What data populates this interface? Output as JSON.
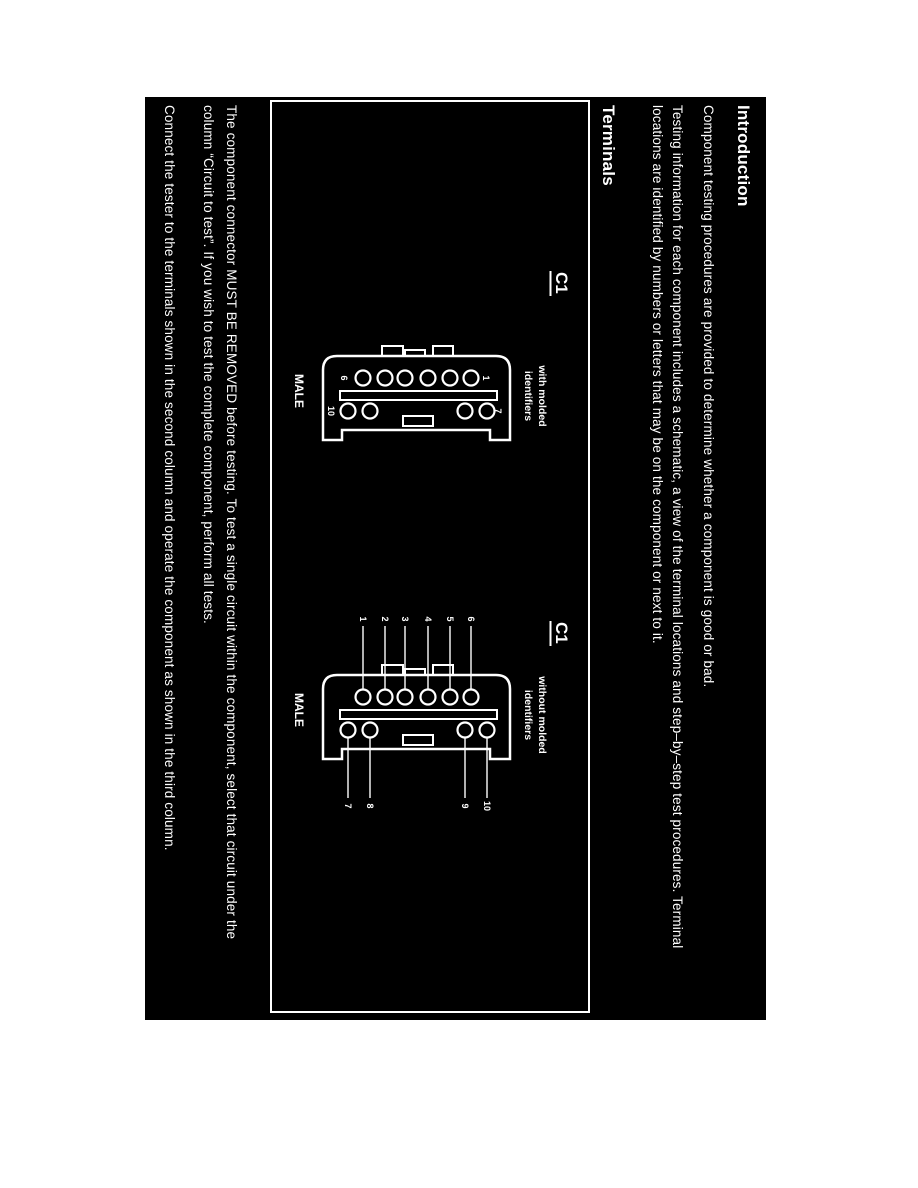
{
  "page": {
    "headings": {
      "introduction": "Introduction",
      "terminals": "Terminals"
    },
    "paragraphs": {
      "p1": "Component testing procedures are provided to determine whether a component is good or bad.",
      "p2_line1": "Testing information for each component includes a schematic, a view of the terminal locations and step–by–step test procedures. Terminal",
      "p2_line2": "locations are identified by numbers or letters that may be on the component or next to it.",
      "p3_line1": "The component connector MUST BE REMOVED before testing. To test a single circuit within the component, select that circuit under the",
      "p3_line2": "column “Circuit to test”. If you wish to test the complete component, perform all tests.",
      "p4": "Connect the tester to the terminals shown in the second column and operate the component as shown in the third column."
    }
  },
  "diagrams": [
    {
      "id": "C1",
      "variant_line1": "with molded",
      "variant_line2": "identifiers",
      "gender_label": "MALE",
      "row1_top_pin_label": "1",
      "row1_bottom_pin_label": "6",
      "row2_top_pin_label": "7",
      "row2_bottom_pin_label": "10"
    },
    {
      "id": "C1",
      "variant_line1": "without molded",
      "variant_line2": "identifiers",
      "gender_label": "MALE",
      "lead_labels_left_top_to_bottom": [
        "6",
        "5",
        "4",
        "3",
        "2",
        "1"
      ],
      "lead_labels_right_top_to_bottom": [
        "10",
        "9",
        "8",
        "7"
      ]
    }
  ],
  "colors": {
    "page_bg": "#ffffff",
    "panel_bg": "#000000",
    "ink": "#ffffff"
  }
}
